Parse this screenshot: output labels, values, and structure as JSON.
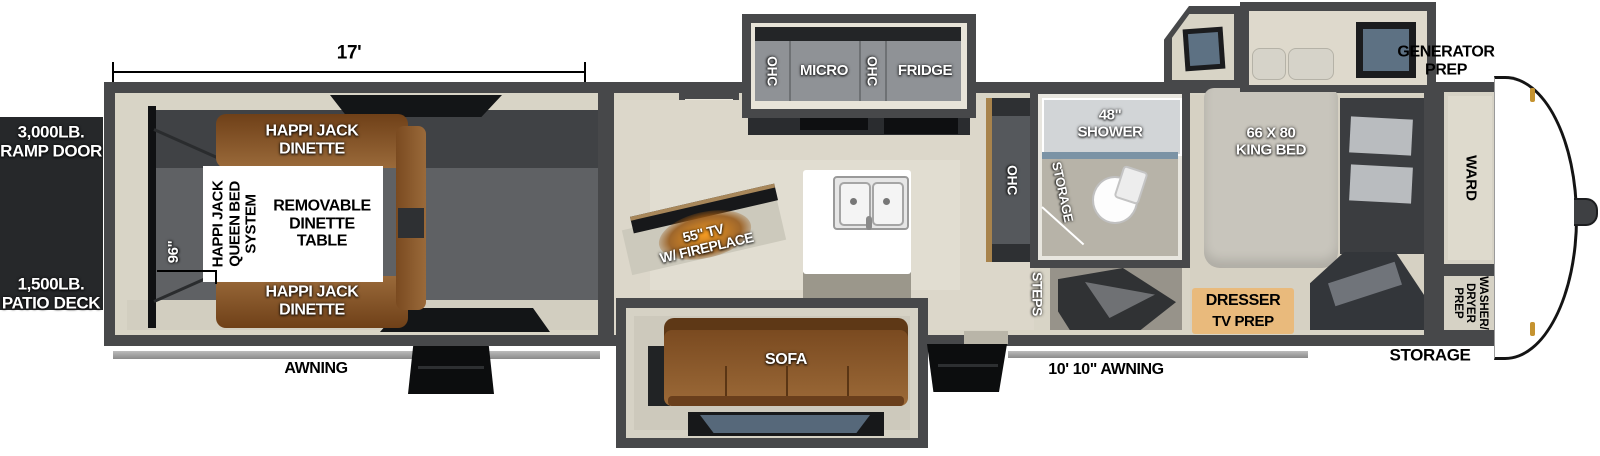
{
  "floorplan": {
    "dimensions": {
      "garage_length": "17'",
      "garage_width": "96\""
    },
    "exterior": {
      "ramp_door": "3,000LB.\nRAMP DOOR",
      "patio_deck": "1,500LB.\nPATIO DECK",
      "awning_rear": "AWNING",
      "awning_main": "10' 10\" AWNING",
      "generator_prep": "GENERATOR\nPREP",
      "storage_front": "STORAGE"
    },
    "garage": {
      "dinette_top": "HAPPI JACK\nDINETTE",
      "dinette_bottom": "HAPPI JACK\nDINETTE",
      "queen_bed_system": "HAPPI JACK\nQUEEN BED\nSYSTEM",
      "removable_table": "REMOVABLE\nDINETTE\nTABLE"
    },
    "living": {
      "pantry": "20 CU FT\nPANTRY",
      "tv_fireplace": "55\" TV\nW/ FIREPLACE",
      "sofa": "SOFA",
      "steps": "STEPS",
      "ohc_left": "OHC",
      "micro": "MICRO",
      "ohc_mid": "OHC",
      "fridge": "FRIDGE",
      "ohc_island": "OHC"
    },
    "bathroom": {
      "shower": "48\"\nSHOWER",
      "storage": "STORAGE"
    },
    "bedroom": {
      "king_bed": "66 X 80\nKING BED",
      "dresser": "DRESSER",
      "tv_prep": "TV PREP",
      "wardrobe": "WARD",
      "washer_dryer": "WASHER/\nDRYER\nPREP"
    },
    "colors": {
      "wall": "#47484a",
      "trim": "#d8d4c6",
      "floor_main": "#dcd7ca",
      "floor_garage": "#5f6164",
      "sofa_brown": "#8a5a30",
      "dresser_tan": "#e9ba7c",
      "cabinet_gray": "#8f9296",
      "fireplace_glow": "#f49a20",
      "ramp_black": "#26282a",
      "glass_blue": "#5d7183",
      "clearance_gold": "#c59330"
    }
  }
}
